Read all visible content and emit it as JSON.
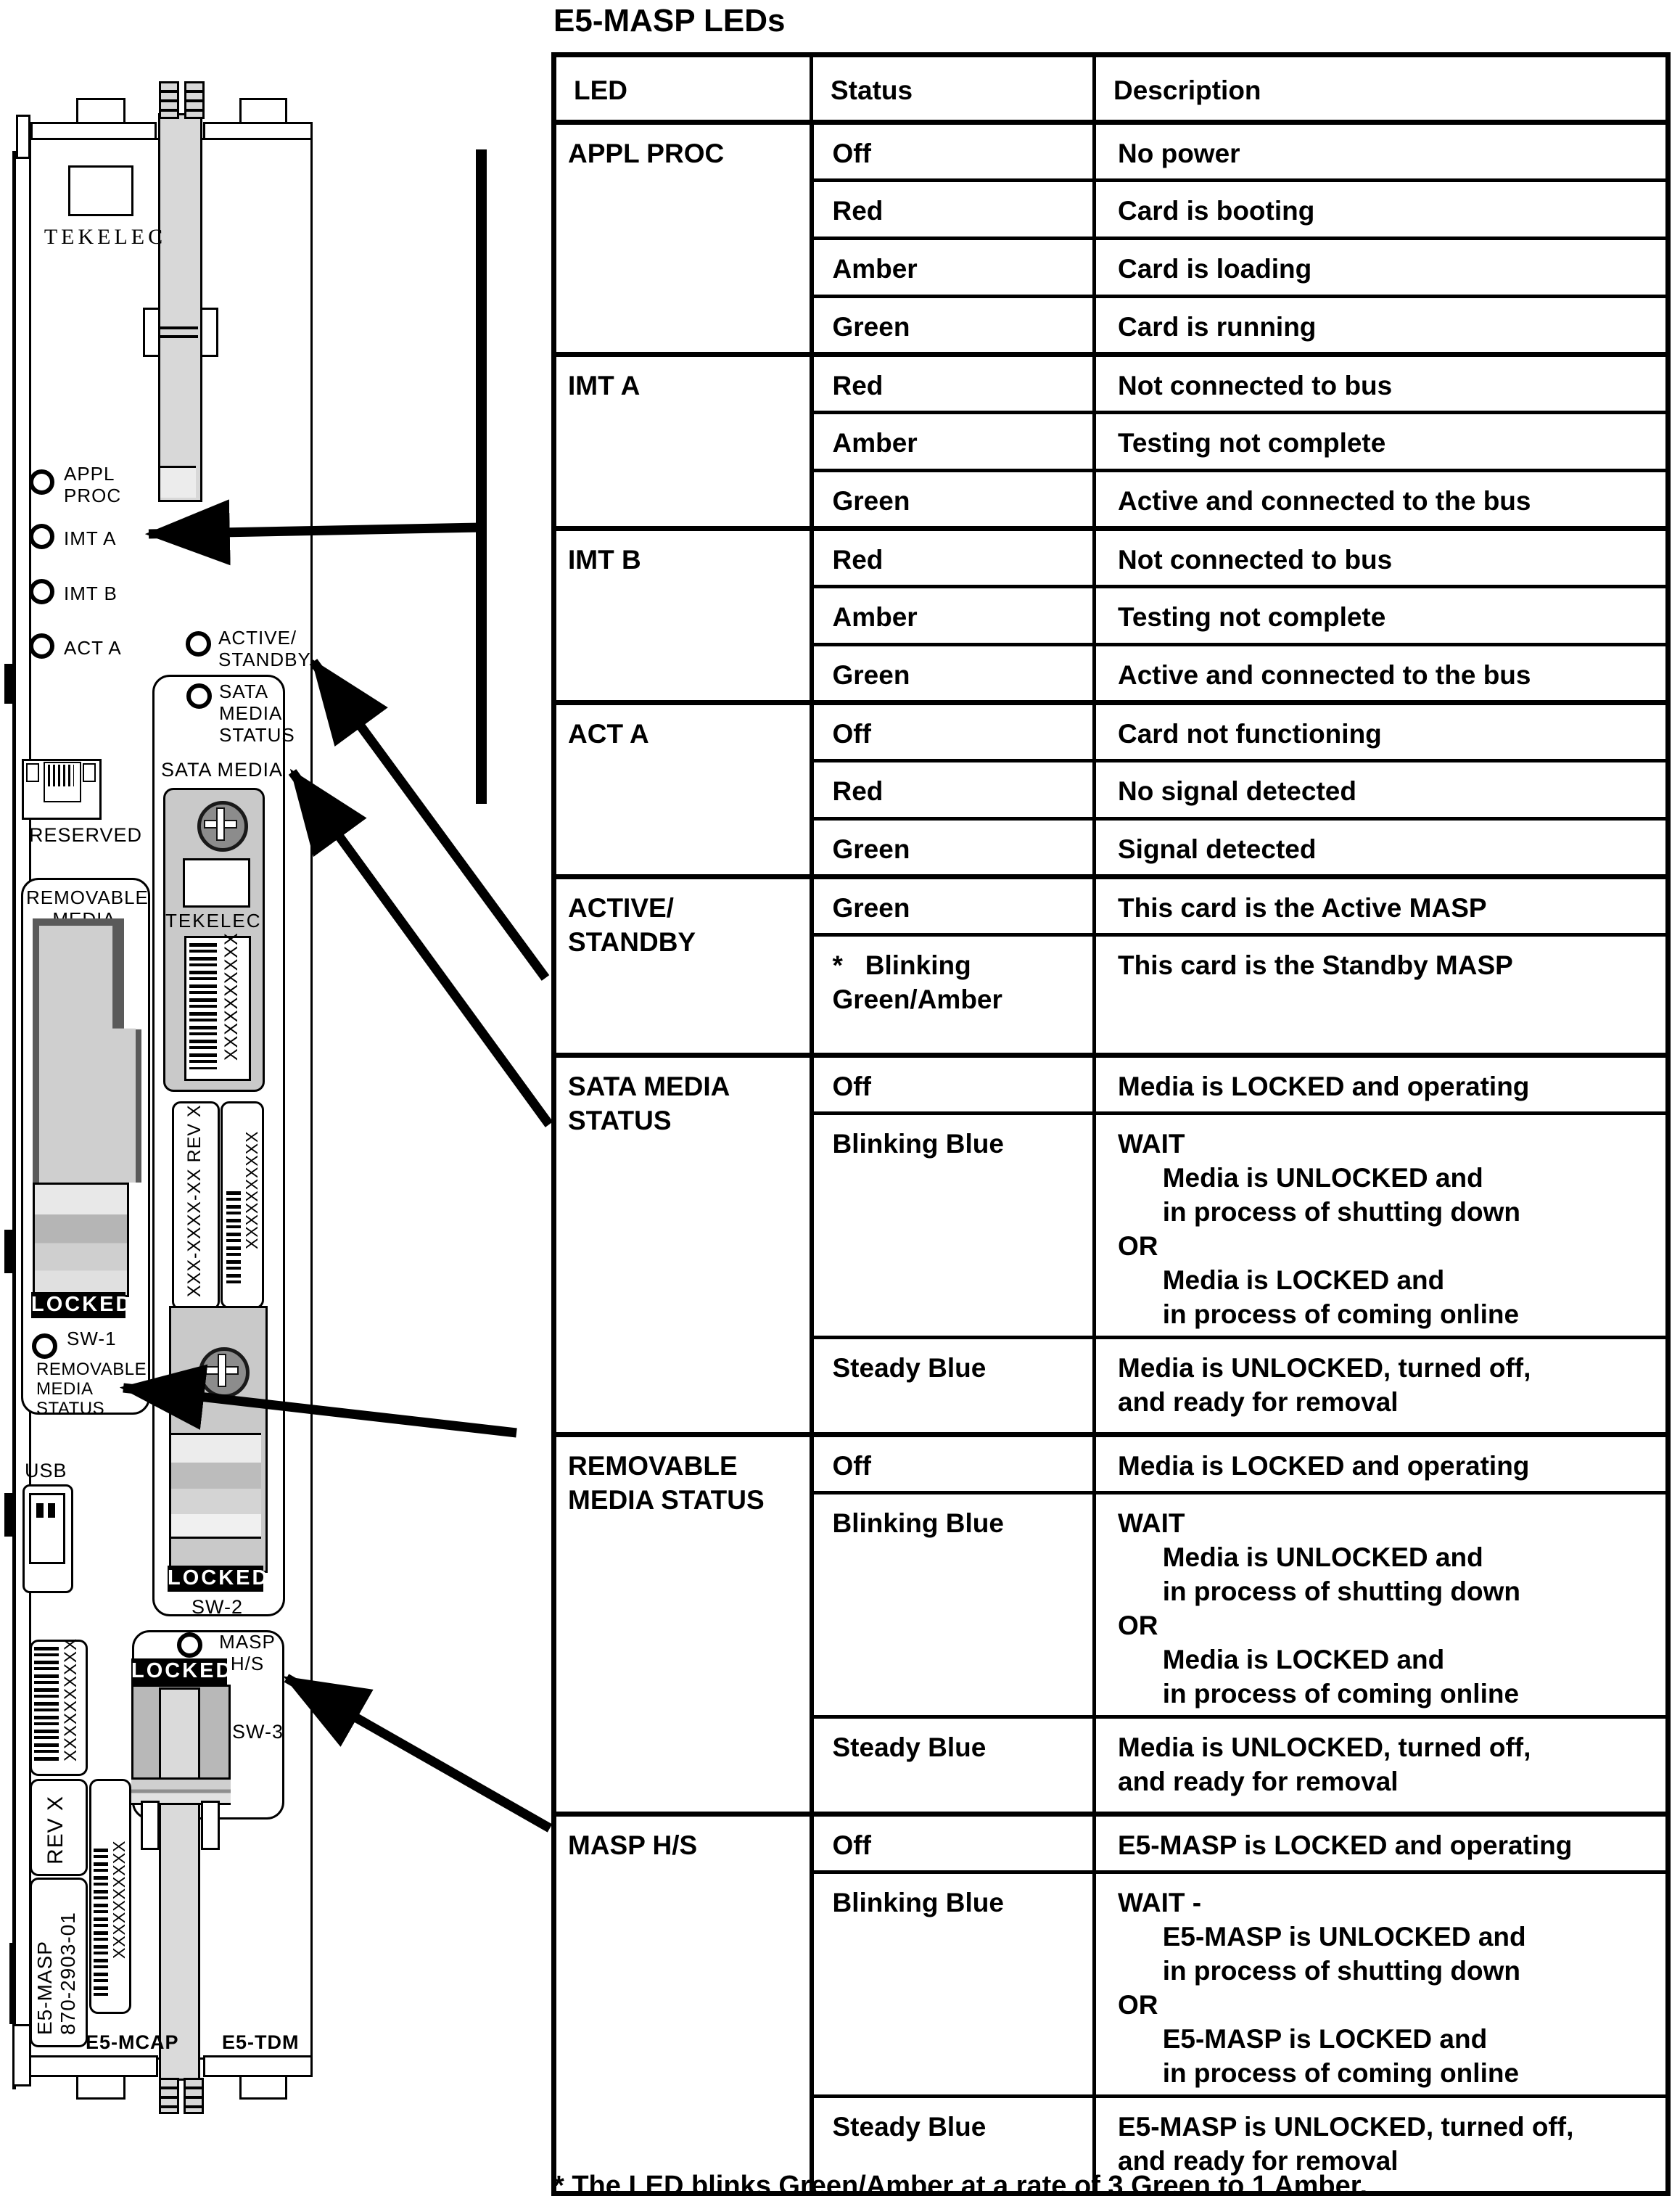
{
  "title": "E5-MASP LEDs",
  "table": {
    "headers": {
      "led": "LED",
      "status": "Status",
      "description": "Description"
    },
    "groups": [
      {
        "led": "APPL PROC",
        "rows": [
          {
            "status": "Off",
            "description": "No power"
          },
          {
            "status": "Red",
            "description": "Card is booting"
          },
          {
            "status": "Amber",
            "description": "Card is loading"
          },
          {
            "status": "Green",
            "description": "Card is running"
          }
        ]
      },
      {
        "led": "IMT A",
        "rows": [
          {
            "status": "Red",
            "description": "Not connected to bus"
          },
          {
            "status": "Amber",
            "description": "Testing not complete"
          },
          {
            "status": "Green",
            "description": "Active and connected to the bus"
          }
        ]
      },
      {
        "led": "IMT B",
        "rows": [
          {
            "status": "Red",
            "description": "Not connected to bus"
          },
          {
            "status": "Amber",
            "description": "Testing not complete"
          },
          {
            "status": "Green",
            "description": "Active and connected to the bus"
          }
        ]
      },
      {
        "led": "ACT A",
        "rows": [
          {
            "status": "Off",
            "description": "Card not functioning"
          },
          {
            "status": "Red",
            "description": "No signal detected"
          },
          {
            "status": "Green",
            "description": "Signal detected"
          }
        ]
      },
      {
        "led": "ACTIVE/\nSTANDBY",
        "rows": [
          {
            "status": "Green",
            "description": "This card is the Active MASP"
          },
          {
            "status": "*   Blinking\nGreen/Amber",
            "description": "This card is the Standby MASP"
          }
        ]
      },
      {
        "led": "SATA MEDIA\nSTATUS",
        "rows": [
          {
            "status": "Off",
            "description": "Media is LOCKED and operating"
          },
          {
            "status": "Blinking Blue",
            "description": "WAIT\n      Media is UNLOCKED and\n      in process of shutting down\nOR\n      Media is LOCKED and\n      in process of coming online"
          },
          {
            "status": "Steady Blue",
            "description": "Media is UNLOCKED, turned off,\nand ready for removal"
          }
        ]
      },
      {
        "led": "REMOVABLE\nMEDIA STATUS",
        "rows": [
          {
            "status": "Off",
            "description": "Media is LOCKED and operating"
          },
          {
            "status": "Blinking Blue",
            "description": "WAIT\n      Media is UNLOCKED and\n      in process of shutting down\nOR\n      Media is LOCKED and\n      in process of coming online"
          },
          {
            "status": "Steady Blue",
            "description": "Media is UNLOCKED, turned off,\nand ready for removal"
          }
        ]
      },
      {
        "led": "MASP H/S",
        "rows": [
          {
            "status": "Off",
            "description": "E5-MASP is LOCKED and operating"
          },
          {
            "status": "Blinking Blue",
            "description": "WAIT -\n      E5-MASP is UNLOCKED and\n      in process of shutting down\nOR\n      E5-MASP is LOCKED and\n      in process of coming online"
          },
          {
            "status": "Steady Blue",
            "description": "E5-MASP is UNLOCKED, turned off,\nand ready for removal"
          }
        ]
      }
    ],
    "footnote": "* The LED blinks Green/Amber at a rate of 3 Green to 1 Amber."
  },
  "card": {
    "brand_top": "TEKELEC",
    "led_appl": "APPL\nPROC",
    "led_imt_a": "IMT  A",
    "led_imt_b": "IMT  B",
    "led_act_a": "ACT  A",
    "led_active_standby": "ACTIVE/\nSTANDBY",
    "led_sata_status": "SATA\nMEDIA\nSTATUS",
    "led_removable_status": "REMOVABLE\nMEDIA\nSTATUS",
    "led_masp_hs": "MASP\nH/S",
    "reserved": "RESERVED",
    "removable_media": "REMOVABLE\nMEDIA",
    "sata_media": "SATA  MEDIA",
    "sata_brand": "TEKELEC",
    "locked": "LOCKED",
    "sw1": "SW-1",
    "sw2": "SW-2",
    "sw3": "SW-3",
    "usb": "USB",
    "barcode_text": "XXXXXXXXXX",
    "part_label": "XXX-XXXX-XX REV X",
    "rev": "REV X",
    "module_name": "E5-MASP",
    "part_number": "870-2903-01",
    "mcap": "E5-MCAP",
    "tdm": "E5-TDM"
  }
}
